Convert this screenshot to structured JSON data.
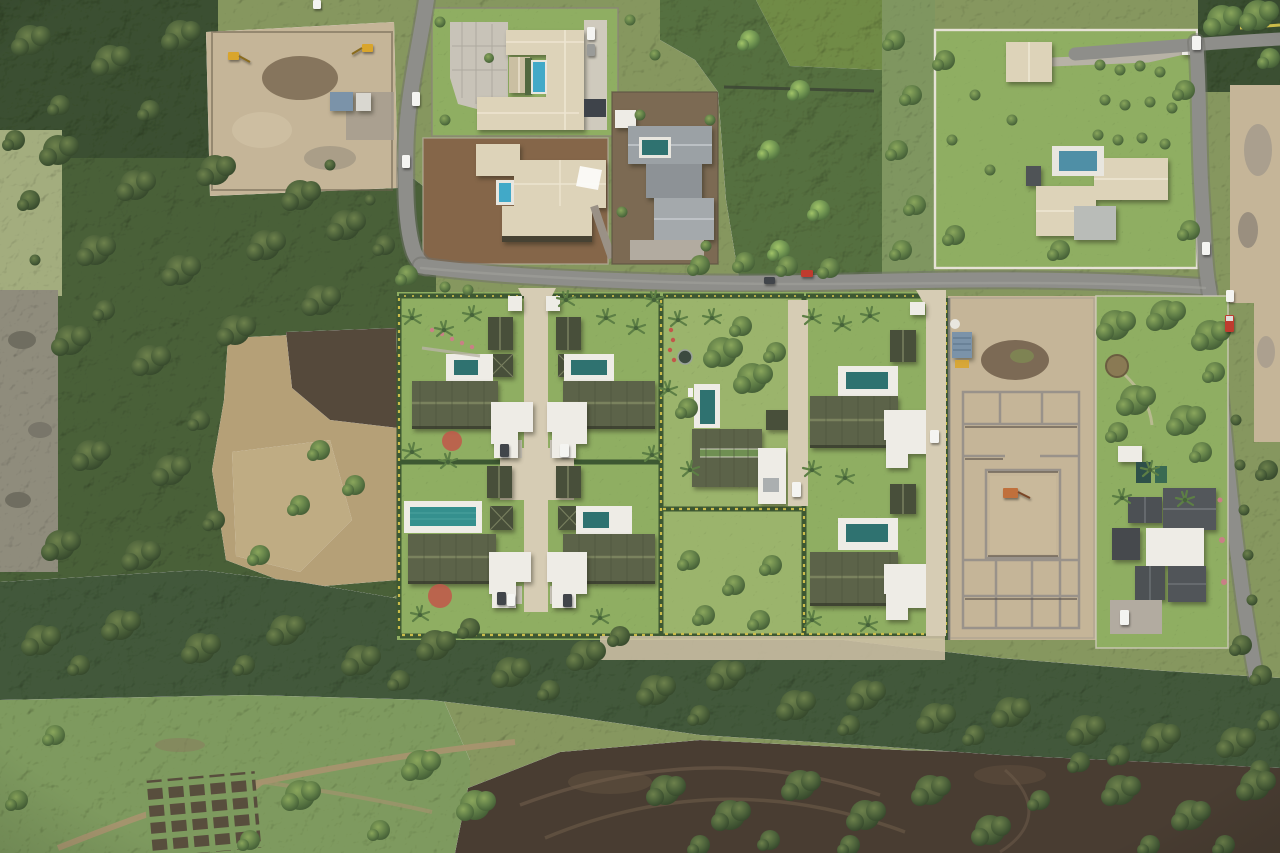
{
  "scene": {
    "title": "Aerial drone photograph of a tropical villa development surrounded by woodland, dry fields, neighbouring estates and construction sites",
    "view": "top-down",
    "lighting": "bright midday sun"
  },
  "development": {
    "new_villas": 6,
    "villa_layout": "two columns of paired villas plus an eastern pair, each with olive metal roof, garden pavilions, white carport and private pool",
    "central_existing_home": 1,
    "driveways": 2,
    "entrance_gates": 3,
    "hedge_color": "yellow-green flowering hedges"
  },
  "surroundings": {
    "estates": [
      "north courtyard estate with U-shaped beige roof and pool",
      "north lot under construction with shade sails and small pool",
      "grey-roofed modern estate on red earth",
      "north-east walled estate with large lawn and pool",
      "south-east garden estate with charcoal roofs and two dark pools"
    ],
    "construction_sites": [
      "north-west cleared earthworks with excavators and site shed",
      "east foundation works with concrete block walls and excavator"
    ],
    "woodland": [
      "west forest",
      "central bamboo grove",
      "southern tree belt"
    ],
    "open_ground": [
      "west dry field with bare soil patch",
      "southern cleared dark soil with tyre tracks",
      "allotment garden beds"
    ]
  },
  "counts": {
    "pools_total": 13,
    "white_vehicles": 8,
    "dark_vehicles": 5,
    "red_vehicles": 2,
    "excavators": 3
  },
  "colors": {
    "base": "#86975f",
    "forest": "#4a6139",
    "forestDark": "#3a4f30",
    "band": "#42593a",
    "lawn": "#8fae62",
    "lawnPale": "#9bb46c",
    "scrub": "#7f9660",
    "scrubLight": "#a3ad7e",
    "dirtTan": "#c5b598",
    "dirtPale": "#d2c4a9",
    "redDirt": "#85664a",
    "soilDark": "#4a3d30",
    "fieldTan": "#b5a077",
    "rock": "#8f8c7c",
    "road": "#8e8e8a",
    "roadEdge": "#6f6f69",
    "drive": "#d6ccb4",
    "concrete": "#c8c3b8",
    "pave": "#b2aba0",
    "roofBeige": "#ddd3b9",
    "roofBeigeDk": "#cabfa2",
    "roofOlive": "#5c6349",
    "roofOliveDark": "#484f3a",
    "ridgeOlive": "#7a825e",
    "roofGrey": "#9ba1a5",
    "roofCharcoal": "#4c5054",
    "roofWhite": "#eeece6",
    "poolTeal": "#2f7270",
    "poolBright": "#35908e",
    "poolBlue": "#41a9c8",
    "poolDark": "#2e5049",
    "hedge": "#3d5832",
    "hedgeY": "#d2c14c",
    "flowerRed": "#c2574a",
    "pinkFlower": "#c97f86",
    "machineYellow": "#d9a52c",
    "shedBlue": "#7b93a9",
    "carWhite": "#f4f4f1",
    "carDark": "#41454a",
    "carRed": "#bf3b2e",
    "track": "#705e4b"
  }
}
